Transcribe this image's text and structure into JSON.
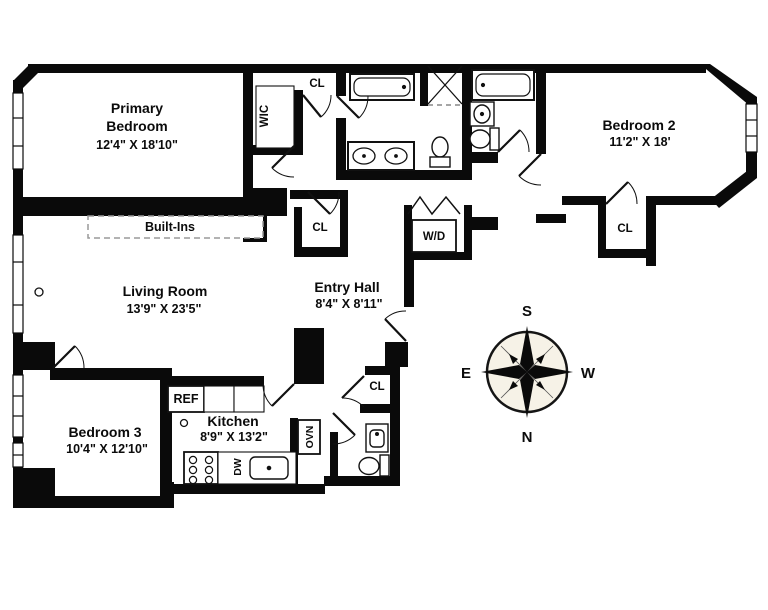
{
  "rooms": {
    "primary_bedroom": {
      "line1": "Primary",
      "line2": "Bedroom",
      "dims": "12'4\" X 18'10\""
    },
    "bedroom_2": {
      "name": "Bedroom 2",
      "dims": "11'2\" X 18'"
    },
    "bedroom_3": {
      "name": "Bedroom 3",
      "dims": "10'4\" X 12'10\""
    },
    "living_room": {
      "name": "Living Room",
      "dims": "13'9\" X 23'5\""
    },
    "entry_hall": {
      "name": "Entry Hall",
      "dims": "8'4\" X 8'11\""
    },
    "kitchen": {
      "name": "Kitchen",
      "dims": "8'9\" X 13'2\""
    }
  },
  "features": {
    "built_ins": "Built-Ins",
    "walk_in_closet": "WIC",
    "washer_dryer": "W/D",
    "closet_hall_top": "CL",
    "closet_hall": "CL",
    "closet_entry": "CL",
    "closet_bedroom_2": "CL",
    "refrigerator": "REF",
    "dishwasher": "DW",
    "oven": "OVN"
  },
  "compass": {
    "top": "S",
    "bottom": "N",
    "left": "E",
    "right": "W"
  },
  "colors": {
    "walls": "#0a0a0a",
    "background": "#ffffff",
    "compass_face": "#f6f2e7"
  }
}
